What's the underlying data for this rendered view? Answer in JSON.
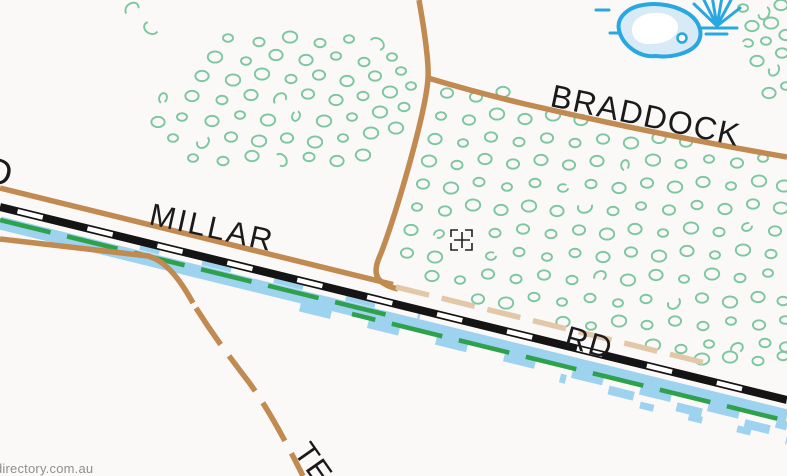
{
  "map": {
    "labels": {
      "left_road_fragment": "D",
      "millar_name": "MILLAR",
      "millar_type": "RD",
      "braddock_name": "BRADDOCK",
      "south_road_fragment": "TE",
      "watermark": "directory.com.au"
    },
    "icons": [
      "lake-icon",
      "swamp-icon",
      "crosshair-cursor"
    ],
    "colors": {
      "bg": "#FBF9F8",
      "road": "#C08A50",
      "track": "#E2C8A8",
      "rail": "#141414",
      "water": "#9ED3F0",
      "waterline": "#29A7E0",
      "lakefill": "#D8EAF6",
      "drain": "#2FA14D",
      "veg": "#7CC79F",
      "label": "#1A1A1A",
      "crosshair": "#222222",
      "watermark": "#8F8F8F"
    },
    "vegetation": {
      "points": [
        [
          132,
          9,
          1
        ],
        [
          151,
          28,
          1
        ],
        [
          228,
          38,
          0
        ],
        [
          259,
          42,
          0
        ],
        [
          290,
          37,
          0
        ],
        [
          320,
          43,
          0
        ],
        [
          349,
          39,
          0
        ],
        [
          377,
          44,
          1
        ],
        [
          215,
          57,
          0
        ],
        [
          246,
          61,
          0
        ],
        [
          276,
          55,
          0
        ],
        [
          306,
          60,
          0
        ],
        [
          336,
          56,
          0
        ],
        [
          364,
          62,
          0
        ],
        [
          392,
          57,
          0
        ],
        [
          202,
          76,
          0
        ],
        [
          233,
          80,
          0
        ],
        [
          262,
          74,
          0
        ],
        [
          291,
          79,
          0
        ],
        [
          319,
          75,
          0
        ],
        [
          347,
          81,
          0
        ],
        [
          375,
          76,
          0
        ],
        [
          401,
          71,
          0
        ],
        [
          163,
          98,
          1
        ],
        [
          192,
          96,
          0
        ],
        [
          222,
          100,
          0
        ],
        [
          251,
          95,
          0
        ],
        [
          280,
          99,
          1
        ],
        [
          308,
          94,
          0
        ],
        [
          336,
          100,
          0
        ],
        [
          363,
          96,
          0
        ],
        [
          390,
          92,
          0
        ],
        [
          411,
          86,
          0
        ],
        [
          158,
          122,
          0
        ],
        [
          182,
          117,
          0
        ],
        [
          212,
          121,
          0
        ],
        [
          240,
          115,
          0
        ],
        [
          268,
          120,
          0
        ],
        [
          296,
          116,
          1
        ],
        [
          324,
          121,
          0
        ],
        [
          352,
          117,
          0
        ],
        [
          380,
          112,
          0
        ],
        [
          404,
          107,
          0
        ],
        [
          173,
          138,
          0
        ],
        [
          203,
          142,
          1
        ],
        [
          231,
          137,
          0
        ],
        [
          259,
          141,
          0
        ],
        [
          287,
          138,
          0
        ],
        [
          315,
          142,
          0
        ],
        [
          343,
          138,
          0
        ],
        [
          371,
          133,
          0
        ],
        [
          396,
          128,
          0
        ],
        [
          193,
          158,
          0
        ],
        [
          223,
          161,
          0
        ],
        [
          252,
          156,
          0
        ],
        [
          281,
          160,
          1
        ],
        [
          309,
          157,
          0
        ],
        [
          337,
          161,
          0
        ],
        [
          363,
          155,
          0
        ],
        [
          447,
          93,
          0
        ],
        [
          476,
          97,
          0
        ],
        [
          503,
          92,
          0
        ],
        [
          441,
          116,
          0
        ],
        [
          469,
          120,
          0
        ],
        [
          497,
          114,
          0
        ],
        [
          525,
          119,
          0
        ],
        [
          553,
          115,
          0
        ],
        [
          581,
          120,
          0
        ],
        [
          435,
          139,
          0
        ],
        [
          463,
          143,
          0
        ],
        [
          491,
          137,
          0
        ],
        [
          519,
          142,
          0
        ],
        [
          547,
          138,
          0
        ],
        [
          575,
          143,
          0
        ],
        [
          603,
          139,
          0
        ],
        [
          631,
          143,
          0
        ],
        [
          659,
          138,
          0
        ],
        [
          686,
          142,
          0
        ],
        [
          429,
          161,
          0
        ],
        [
          457,
          165,
          0
        ],
        [
          485,
          159,
          0
        ],
        [
          513,
          164,
          0
        ],
        [
          541,
          160,
          0
        ],
        [
          569,
          165,
          0
        ],
        [
          597,
          161,
          0
        ],
        [
          625,
          165,
          1
        ],
        [
          653,
          160,
          0
        ],
        [
          681,
          164,
          0
        ],
        [
          709,
          159,
          0
        ],
        [
          737,
          163,
          0
        ],
        [
          763,
          158,
          0
        ],
        [
          423,
          184,
          0
        ],
        [
          451,
          188,
          0
        ],
        [
          479,
          182,
          0
        ],
        [
          507,
          187,
          0
        ],
        [
          535,
          183,
          0
        ],
        [
          563,
          188,
          1
        ],
        [
          591,
          184,
          0
        ],
        [
          619,
          188,
          0
        ],
        [
          647,
          183,
          0
        ],
        [
          675,
          187,
          0
        ],
        [
          703,
          182,
          0
        ],
        [
          731,
          186,
          0
        ],
        [
          759,
          181,
          0
        ],
        [
          784,
          186,
          0
        ],
        [
          417,
          207,
          0
        ],
        [
          445,
          211,
          0
        ],
        [
          473,
          205,
          0
        ],
        [
          501,
          210,
          0
        ],
        [
          529,
          206,
          0
        ],
        [
          557,
          211,
          0
        ],
        [
          585,
          207,
          1
        ],
        [
          613,
          211,
          0
        ],
        [
          641,
          206,
          0
        ],
        [
          669,
          210,
          0
        ],
        [
          697,
          205,
          0
        ],
        [
          725,
          209,
          0
        ],
        [
          753,
          204,
          0
        ],
        [
          781,
          208,
          0
        ],
        [
          411,
          230,
          0
        ],
        [
          439,
          234,
          1
        ],
        [
          495,
          233,
          0
        ],
        [
          523,
          229,
          0
        ],
        [
          551,
          234,
          0
        ],
        [
          579,
          230,
          0
        ],
        [
          607,
          234,
          0
        ],
        [
          635,
          229,
          0
        ],
        [
          663,
          233,
          0
        ],
        [
          691,
          228,
          0
        ],
        [
          719,
          232,
          0
        ],
        [
          747,
          227,
          1
        ],
        [
          775,
          231,
          0
        ],
        [
          407,
          253,
          0
        ],
        [
          435,
          257,
          0
        ],
        [
          491,
          256,
          1
        ],
        [
          519,
          252,
          0
        ],
        [
          547,
          257,
          0
        ],
        [
          575,
          253,
          0
        ],
        [
          603,
          257,
          0
        ],
        [
          631,
          252,
          0
        ],
        [
          659,
          256,
          0
        ],
        [
          687,
          251,
          0
        ],
        [
          715,
          255,
          0
        ],
        [
          743,
          250,
          0
        ],
        [
          771,
          254,
          0
        ],
        [
          432,
          276,
          0
        ],
        [
          460,
          280,
          0
        ],
        [
          488,
          274,
          0
        ],
        [
          516,
          279,
          0
        ],
        [
          544,
          275,
          0
        ],
        [
          572,
          280,
          0
        ],
        [
          600,
          276,
          1
        ],
        [
          628,
          280,
          0
        ],
        [
          656,
          275,
          0
        ],
        [
          684,
          279,
          0
        ],
        [
          712,
          274,
          0
        ],
        [
          740,
          278,
          0
        ],
        [
          768,
          273,
          0
        ],
        [
          478,
          299,
          0
        ],
        [
          506,
          303,
          0
        ],
        [
          534,
          297,
          0
        ],
        [
          562,
          302,
          0
        ],
        [
          590,
          298,
          0
        ],
        [
          618,
          303,
          0
        ],
        [
          646,
          299,
          0
        ],
        [
          674,
          303,
          1
        ],
        [
          702,
          298,
          0
        ],
        [
          730,
          302,
          0
        ],
        [
          758,
          297,
          0
        ],
        [
          783,
          301,
          0
        ],
        [
          563,
          322,
          0
        ],
        [
          591,
          326,
          0
        ],
        [
          619,
          321,
          0
        ],
        [
          647,
          325,
          0
        ],
        [
          675,
          321,
          0
        ],
        [
          703,
          326,
          0
        ],
        [
          731,
          321,
          0
        ],
        [
          759,
          325,
          0
        ],
        [
          785,
          320,
          0
        ],
        [
          653,
          345,
          0
        ],
        [
          681,
          349,
          0
        ],
        [
          709,
          344,
          0
        ],
        [
          737,
          348,
          1
        ],
        [
          765,
          343,
          0
        ],
        [
          786,
          347,
          0
        ],
        [
          702,
          359,
          0
        ],
        [
          730,
          357,
          0
        ],
        [
          758,
          361,
          0
        ],
        [
          783,
          356,
          0
        ],
        [
          743,
          8,
          0
        ],
        [
          764,
          13,
          1
        ],
        [
          781,
          5,
          0
        ],
        [
          752,
          26,
          0
        ],
        [
          771,
          23,
          0
        ],
        [
          786,
          35,
          0
        ],
        [
          748,
          43,
          1
        ],
        [
          766,
          41,
          0
        ],
        [
          782,
          53,
          0
        ],
        [
          757,
          61,
          0
        ],
        [
          774,
          70,
          1
        ],
        [
          786,
          86,
          0
        ],
        [
          769,
          93,
          0
        ]
      ]
    }
  }
}
